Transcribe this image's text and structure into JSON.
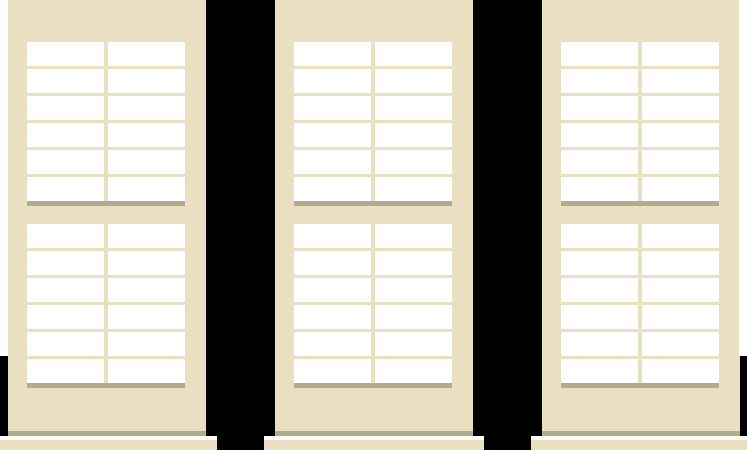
{
  "scene": {
    "description": "illustration of three plantation window shutter panels on a black background",
    "background_color": "#000000"
  },
  "colors": {
    "frame_cream": "#ebdfc1",
    "louver_white": "#ffffff",
    "rail_shadow": "#b3ab90",
    "sill_highlight": "#fdfcf6",
    "edge_sliver_white": "#ffffff",
    "background_black": "#000000"
  },
  "layout": {
    "canvas": {
      "width": 747,
      "height": 450
    },
    "panels": [
      {
        "left": 8
      },
      {
        "left": 275
      },
      {
        "left": 542
      }
    ],
    "panel": {
      "width": 198,
      "body_height": 431,
      "bottom_shadow_height": 5,
      "louver_area_left": 19,
      "louver_area_width": 158,
      "column_count": 2,
      "column_width": 77,
      "column_gap": 4,
      "slat_height": 24,
      "slat_pitch": 27,
      "slats_per_tier": 6,
      "tier_tops": [
        42,
        224
      ],
      "tier_shadow_tops": [
        201,
        383
      ],
      "tier_shadow_height": 5,
      "sill_overhang": 11,
      "sill_width": 220,
      "sill_highlight_top": 436,
      "sill_highlight_height": 4,
      "sill_top": 440,
      "sill_height": 10
    },
    "edge_slivers": [
      {
        "left": 0,
        "top": 0,
        "width": 8,
        "height": 356
      },
      {
        "left": 739,
        "top": 0,
        "width": 8,
        "height": 356
      }
    ]
  }
}
